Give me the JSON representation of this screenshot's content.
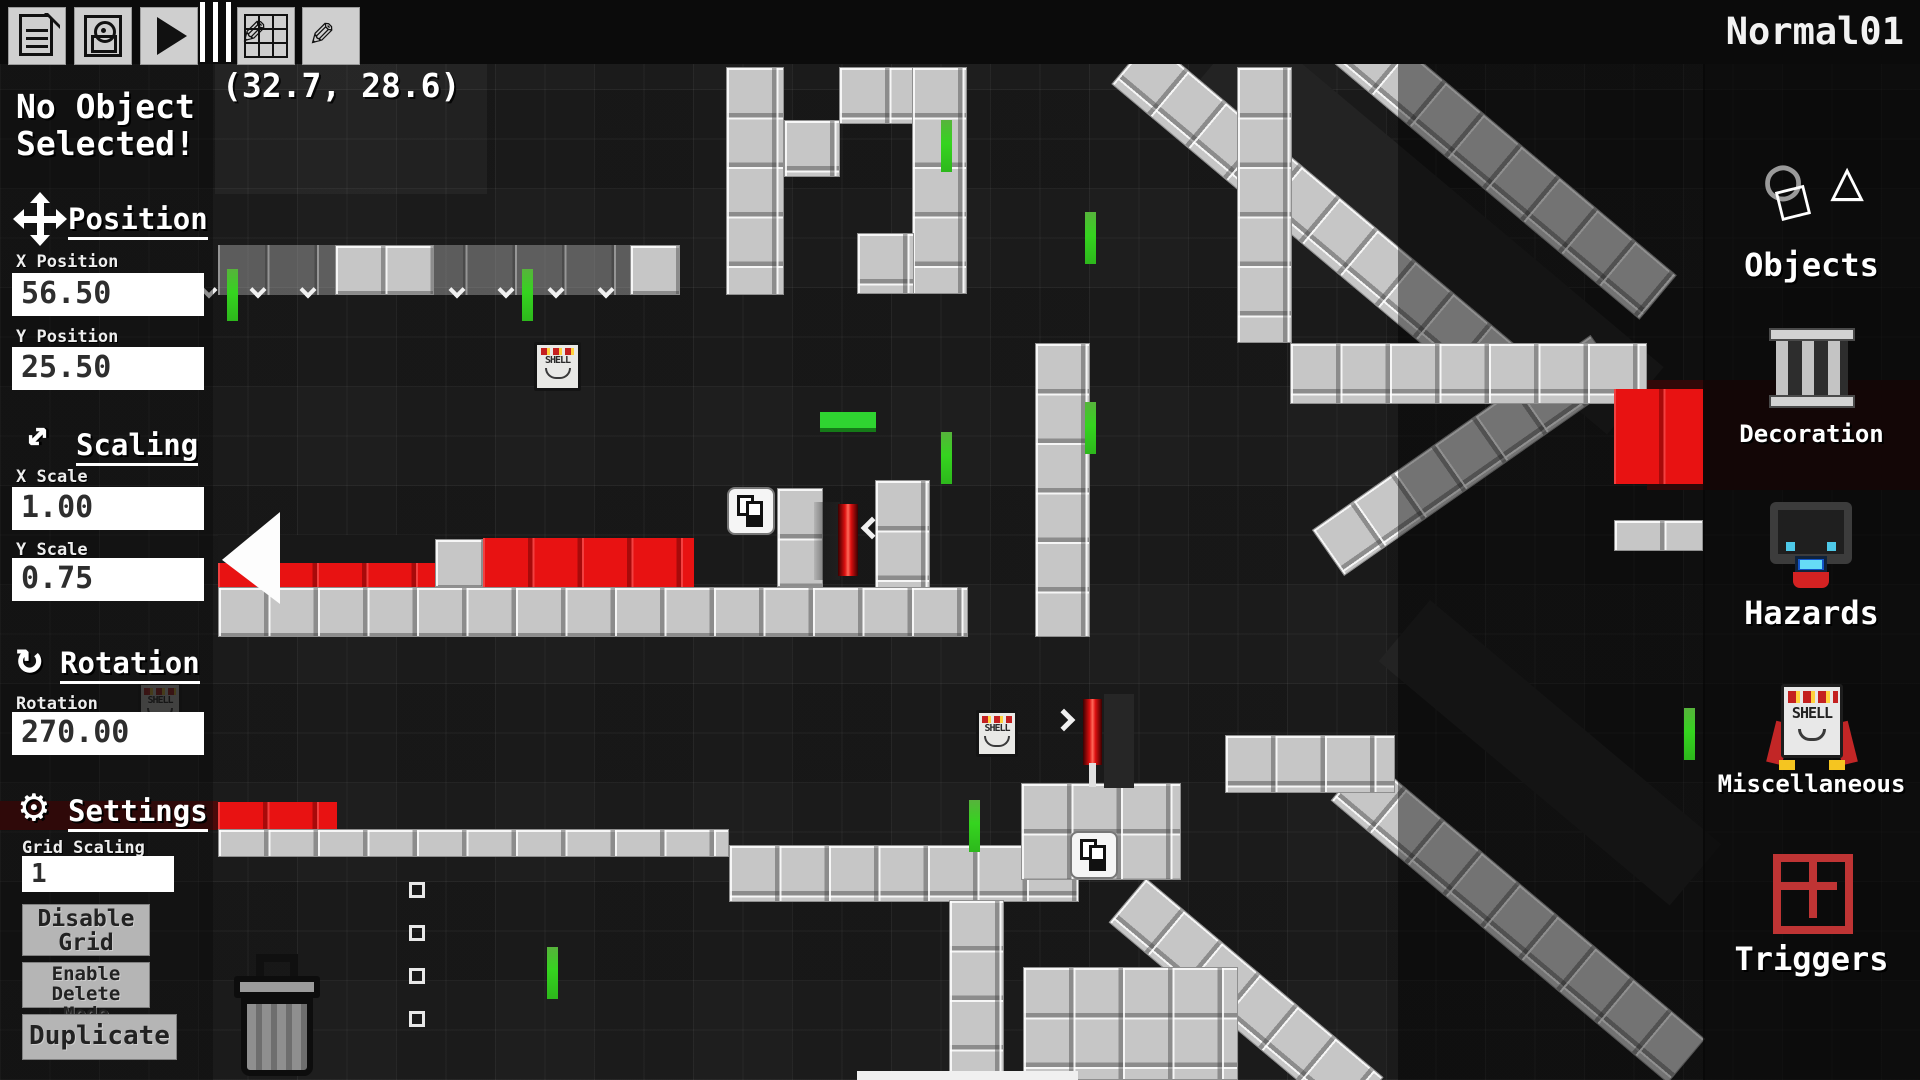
{
  "window": {
    "title": "Normal01",
    "cursor_coordinates": "(32.7, 28.6)"
  },
  "toolbar": {
    "buttons": [
      "new-file",
      "save",
      "play",
      "resize-room",
      "draw"
    ]
  },
  "icons": {
    "scaling_glyph": "↔",
    "rotation_glyph": "↻",
    "settings_glyph": "⚙",
    "objects_circle": "○",
    "objects_triangle": "△",
    "objects_square": "□",
    "pencil_glyph": "✎"
  },
  "inspector": {
    "no_selection_line1": "No Object",
    "no_selection_line2": "Selected!",
    "position": {
      "header": "Position",
      "x_label": "X Position",
      "x_value": "56.50",
      "y_label": "Y Position",
      "y_value": "25.50"
    },
    "scaling": {
      "header": "Scaling",
      "x_label": "X Scale",
      "x_value": "1.00",
      "y_label": "Y Scale",
      "y_value": "0.75"
    },
    "rotation": {
      "header": "Rotation",
      "label": "Rotation",
      "value": "270.00"
    },
    "settings": {
      "header": "Settings",
      "grid_scaling_label": "Grid Scaling",
      "grid_scaling_value": "1",
      "buttons": [
        "Disable Grid",
        "Enable Delete Mode",
        "Duplicate"
      ]
    }
  },
  "palette": {
    "items": [
      {
        "id": "objects",
        "label": "Objects"
      },
      {
        "id": "decoration",
        "label": "Decoration"
      },
      {
        "id": "hazards",
        "label": "Hazards"
      },
      {
        "id": "miscellaneous",
        "label": "Miscellaneous"
      },
      {
        "id": "triggers",
        "label": "Triggers"
      }
    ]
  },
  "shell_label": "SHELL",
  "colors": {
    "accent_red": "#e81212",
    "accent_green": "#35d41f",
    "tile_light": "#c6c6c6",
    "background": "#1a1a1a"
  },
  "level": {
    "beams": [
      {
        "x": 1250,
        "y": 20,
        "len": 540,
        "thick": 88,
        "angle": 40,
        "dark": true
      },
      {
        "x": 1430,
        "y": 600,
        "len": 380,
        "thick": 80,
        "angle": 40,
        "dark": true
      },
      {
        "x": 1150,
        "y": 38,
        "len": 540,
        "thick": 60,
        "angle": 40
      },
      {
        "x": 1332,
        "y": -14,
        "len": 450,
        "thick": 58,
        "angle": 40
      },
      {
        "x": 1312,
        "y": 530,
        "len": 340,
        "thick": 56,
        "angle": -35
      },
      {
        "x": 1368,
        "y": 756,
        "len": 440,
        "thick": 58,
        "angle": 40
      },
      {
        "x": 1146,
        "y": 878,
        "len": 310,
        "thick": 58,
        "angle": 40
      }
    ],
    "tiles": [
      {
        "x": 215,
        "y": 64,
        "w": 272,
        "h": 130,
        "t": "dim"
      },
      {
        "x": 1398,
        "y": 64,
        "w": 307,
        "h": 1016,
        "t": "dark3"
      },
      {
        "x": 218,
        "y": 245,
        "w": 460,
        "h": 50,
        "t": "translight"
      },
      {
        "x": 335,
        "y": 245,
        "w": 99,
        "h": 50,
        "t": "light"
      },
      {
        "x": 630,
        "y": 245,
        "w": 50,
        "h": 50,
        "t": "light"
      },
      {
        "x": 726,
        "y": 67,
        "w": 58,
        "h": 228,
        "t": "light"
      },
      {
        "x": 784,
        "y": 120,
        "w": 56,
        "h": 57,
        "t": "light"
      },
      {
        "x": 839,
        "y": 67,
        "w": 75,
        "h": 57,
        "t": "light"
      },
      {
        "x": 912,
        "y": 67,
        "w": 55,
        "h": 227,
        "t": "light"
      },
      {
        "x": 857,
        "y": 233,
        "w": 57,
        "h": 61,
        "t": "light"
      },
      {
        "x": 777,
        "y": 488,
        "w": 46,
        "h": 99,
        "t": "light"
      },
      {
        "x": 875,
        "y": 480,
        "w": 55,
        "h": 157,
        "t": "light"
      },
      {
        "x": 1035,
        "y": 343,
        "w": 55,
        "h": 294,
        "t": "light"
      },
      {
        "x": 218,
        "y": 535,
        "w": 217,
        "h": 29,
        "t": "dark"
      },
      {
        "x": 218,
        "y": 563,
        "w": 217,
        "h": 24,
        "t": "red"
      },
      {
        "x": 435,
        "y": 539,
        "w": 48,
        "h": 48,
        "t": "light"
      },
      {
        "x": 483,
        "y": 538,
        "w": 211,
        "h": 49,
        "t": "red"
      },
      {
        "x": 218,
        "y": 587,
        "w": 750,
        "h": 50,
        "t": "light"
      },
      {
        "x": 0,
        "y": 801,
        "w": 218,
        "h": 29,
        "t": "darkband"
      },
      {
        "x": 218,
        "y": 802,
        "w": 119,
        "h": 27,
        "t": "red"
      },
      {
        "x": 218,
        "y": 829,
        "w": 511,
        "h": 28,
        "t": "light"
      },
      {
        "x": 729,
        "y": 845,
        "w": 350,
        "h": 57,
        "t": "light"
      },
      {
        "x": 1021,
        "y": 783,
        "w": 160,
        "h": 97,
        "t": "light"
      },
      {
        "x": 949,
        "y": 900,
        "w": 55,
        "h": 180,
        "t": "light"
      },
      {
        "x": 1023,
        "y": 967,
        "w": 215,
        "h": 113,
        "t": "light"
      },
      {
        "x": 857,
        "y": 1071,
        "w": 221,
        "h": 9,
        "t": "white"
      },
      {
        "x": 1290,
        "y": 343,
        "w": 357,
        "h": 61,
        "t": "light"
      },
      {
        "x": 1237,
        "y": 67,
        "w": 55,
        "h": 276,
        "t": "light"
      },
      {
        "x": 1647,
        "y": 380,
        "w": 273,
        "h": 110,
        "t": "darkred"
      },
      {
        "x": 1614,
        "y": 389,
        "w": 89,
        "h": 95,
        "t": "red"
      },
      {
        "x": 1614,
        "y": 520,
        "w": 89,
        "h": 31,
        "t": "light"
      },
      {
        "x": 1225,
        "y": 735,
        "w": 170,
        "h": 58,
        "t": "light"
      },
      {
        "x": 820,
        "y": 412,
        "w": 56,
        "h": 16,
        "t": "greenplat"
      }
    ],
    "greens": [
      [
        227,
        269
      ],
      [
        522,
        269
      ],
      [
        941,
        120
      ],
      [
        1085,
        212
      ],
      [
        941,
        432
      ],
      [
        1085,
        402
      ],
      [
        969,
        800
      ],
      [
        1684,
        708
      ],
      [
        547,
        947
      ]
    ],
    "chevrons_down": {
      "y": 284,
      "xs": [
        203,
        252,
        302,
        451,
        500,
        550,
        600
      ]
    },
    "squares": [
      [
        409,
        882
      ],
      [
        409,
        925
      ],
      [
        409,
        968
      ],
      [
        409,
        1011
      ]
    ],
    "objects": [
      {
        "type": "wedge",
        "x": 222,
        "y": 512
      },
      {
        "type": "shell-box",
        "x": 534,
        "y": 342,
        "w": 47,
        "h": 49
      },
      {
        "type": "shell-box",
        "x": 976,
        "y": 710,
        "w": 42,
        "h": 47
      },
      {
        "type": "shell-box",
        "x": 138,
        "y": 682,
        "w": 44,
        "h": 48,
        "dim": true
      },
      {
        "type": "copy-tile",
        "x": 727,
        "y": 487
      },
      {
        "type": "copy-tile",
        "x": 1070,
        "y": 831
      },
      {
        "type": "laser-left",
        "x": 814,
        "y": 500
      },
      {
        "type": "laser-right",
        "x": 1083,
        "y": 694
      },
      {
        "type": "chev-left",
        "x": 864,
        "y": 520
      },
      {
        "type": "chev-right",
        "x": 1056,
        "y": 712
      },
      {
        "type": "trash",
        "x": 234,
        "y": 954
      }
    ]
  }
}
